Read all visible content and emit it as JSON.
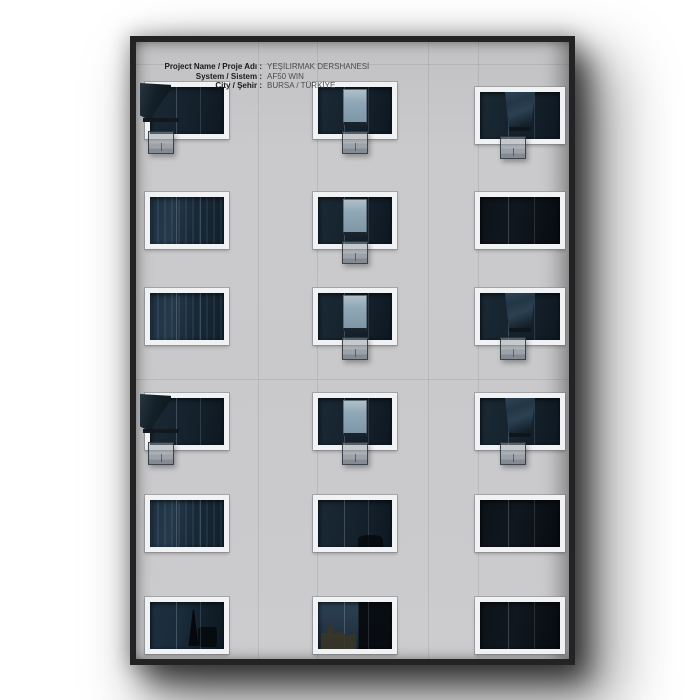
{
  "caption": {
    "rows": [
      {
        "label": "Project Name / Proje Adı :",
        "value": "YEŞİLIRMAK DERSHANESİ"
      },
      {
        "label": "System / Sistem :",
        "value": "AF50 WIN"
      },
      {
        "label": "City / Şehir :",
        "value": "BURSA / TÜRKİYE"
      }
    ],
    "label_color": "#1a1a1a",
    "value_color": "#4c4c4f"
  },
  "photo": {
    "subject": "building-facade-with-window-grid",
    "frame_border_color": "#232323",
    "wall_color": "#c8c8ca",
    "window_frame_color": "#f1f2f3",
    "glass_color": "#15232e",
    "glass_dark_color": "#0b1016",
    "open_pane_light_color": "#8da4b4",
    "open_sash_dark_color": "#1a2833",
    "vent_flap_color": "rgba(148,158,166,0.52)",
    "window_states_grid": [
      [
        "open-swing",
        "tilt-light",
        "tilt-dark"
      ],
      [
        "closed-curtain",
        "tilt-light",
        "closed-dark"
      ],
      [
        "closed-curtain",
        "tilt-light",
        "tilt-dark"
      ],
      [
        "open-swing",
        "tilt-light",
        "tilt-dark"
      ],
      [
        "closed-curtain",
        "closed-plain",
        "closed-dark"
      ],
      [
        "closed-spire",
        "closed-building",
        "closed-dark"
      ]
    ]
  },
  "page_background": "#ffffff"
}
